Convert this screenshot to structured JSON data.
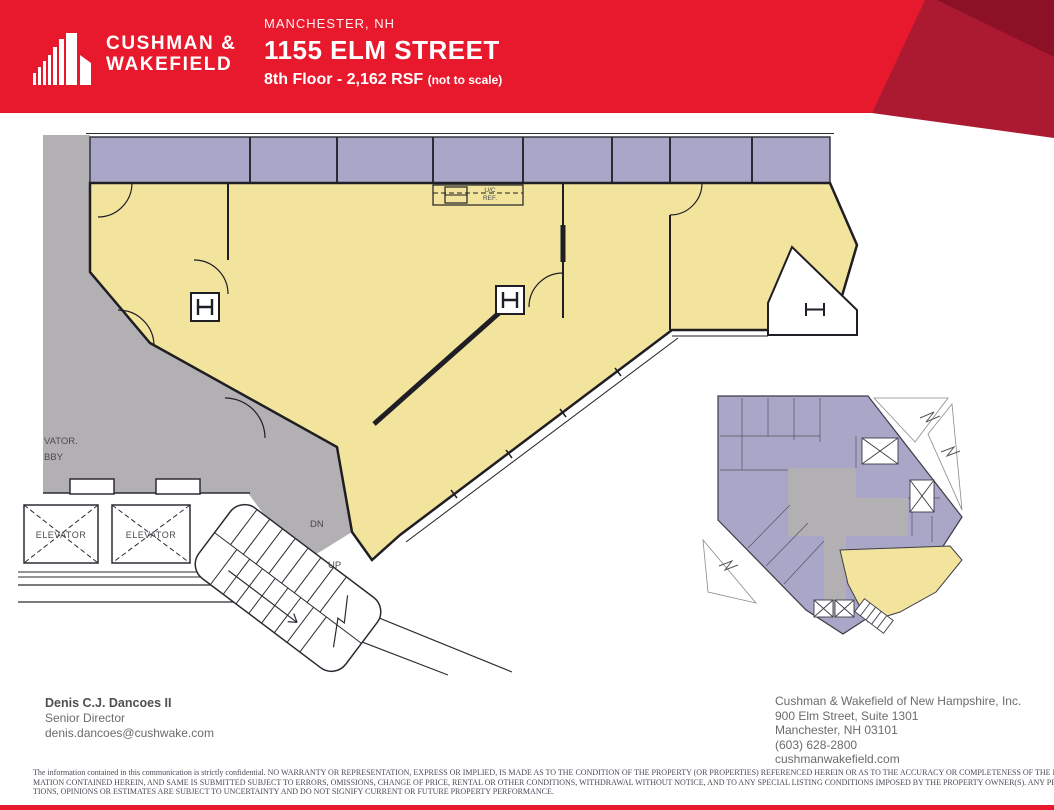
{
  "header": {
    "brand_line1": "CUSHMAN &",
    "brand_line2": "WAKEFIELD",
    "location": "MANCHESTER, NH",
    "title": "1155 ELM STREET",
    "subtitle": "8th Floor - 2,162 RSF",
    "subtitle_note": "(not to scale)"
  },
  "plan": {
    "lobby_label_line1": "VATOR.",
    "lobby_label_line2": "BBY",
    "elevator_label": "ELEVATOR",
    "stair_down_label": "DN",
    "stair_up_label": "UP",
    "kitchen_label_line1": "U/C",
    "kitchen_label_line2": "REF.",
    "suite_color": "#f3e49d",
    "other_space_color": "#a9a6c8",
    "common_area_color": "#b2b0b2"
  },
  "contact": {
    "name": "Denis C.J. Dancoes II",
    "title": "Senior Director",
    "email": "denis.dancoes@cushwake.com"
  },
  "company": {
    "name": "Cushman & Wakefield of New Hampshire, Inc.",
    "address1": "900 Elm Street, Suite 1301",
    "address2": "Manchester, NH 03101",
    "phone": "(603) 628-2800",
    "website": "cushmanwakefield.com"
  },
  "disclaimer": {
    "line1": "The information contained in this communication is strictly confidential. NO WARRANTY OR REPRESENTATION, EXPRESS OR IMPLIED, IS MADE AS TO THE CONDITION OF THE PROPERTY (OR PROPERTIES) REFERENCED HEREIN OR AS TO THE ACCURACY OR COMPLETENESS OF THE INFOR-",
    "line2": "MATION CONTAINED HEREIN, AND SAME IS SUBMITTED SUBJECT TO ERRORS, OMISSIONS, CHANGE OF PRICE, RENTAL OR OTHER CONDITIONS, WITHDRAWAL WITHOUT NOTICE, AND TO ANY SPECIAL LISTING CONDITIONS IMPOSED BY THE PROPERTY OWNER(S).  ANY PROJEC-",
    "line3": "TIONS, OPINIONS OR ESTIMATES ARE SUBJECT TO UNCERTAINTY AND DO NOT SIGNIFY CURRENT OR FUTURE PROPERTY PERFORMANCE."
  },
  "colors": {
    "brand_red": "#e8192c",
    "brand_red_dark": "#ab1a31",
    "brand_red_darker": "#8c1127"
  }
}
